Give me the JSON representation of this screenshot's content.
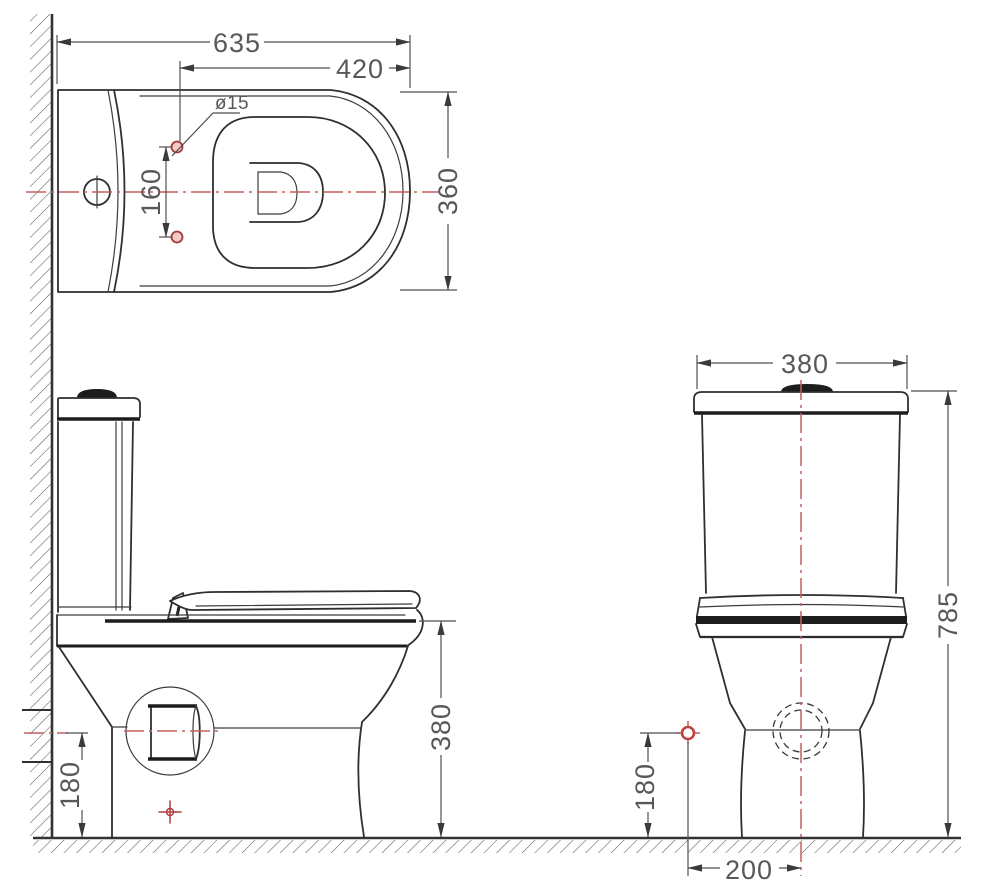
{
  "views": {
    "top": {
      "dims": {
        "total_depth": "635",
        "seat_depth": "420",
        "bowl_width": "360",
        "hole_spacing": "160",
        "hole_diameter": "ø15"
      }
    },
    "side": {
      "dims": {
        "outlet_height": "180",
        "seat_height": "380"
      }
    },
    "front": {
      "dims": {
        "tank_width": "380",
        "total_height": "785",
        "supply_height": "180",
        "supply_offset": "200"
      }
    }
  },
  "colors": {
    "line": "#2f2f2f",
    "thick_line": "#1c1c1c",
    "dimension": "#4f4f4f",
    "text": "#585858",
    "centerline_red": "#c65f5f",
    "marker_red": "#b23c3c",
    "background": "#ffffff"
  }
}
